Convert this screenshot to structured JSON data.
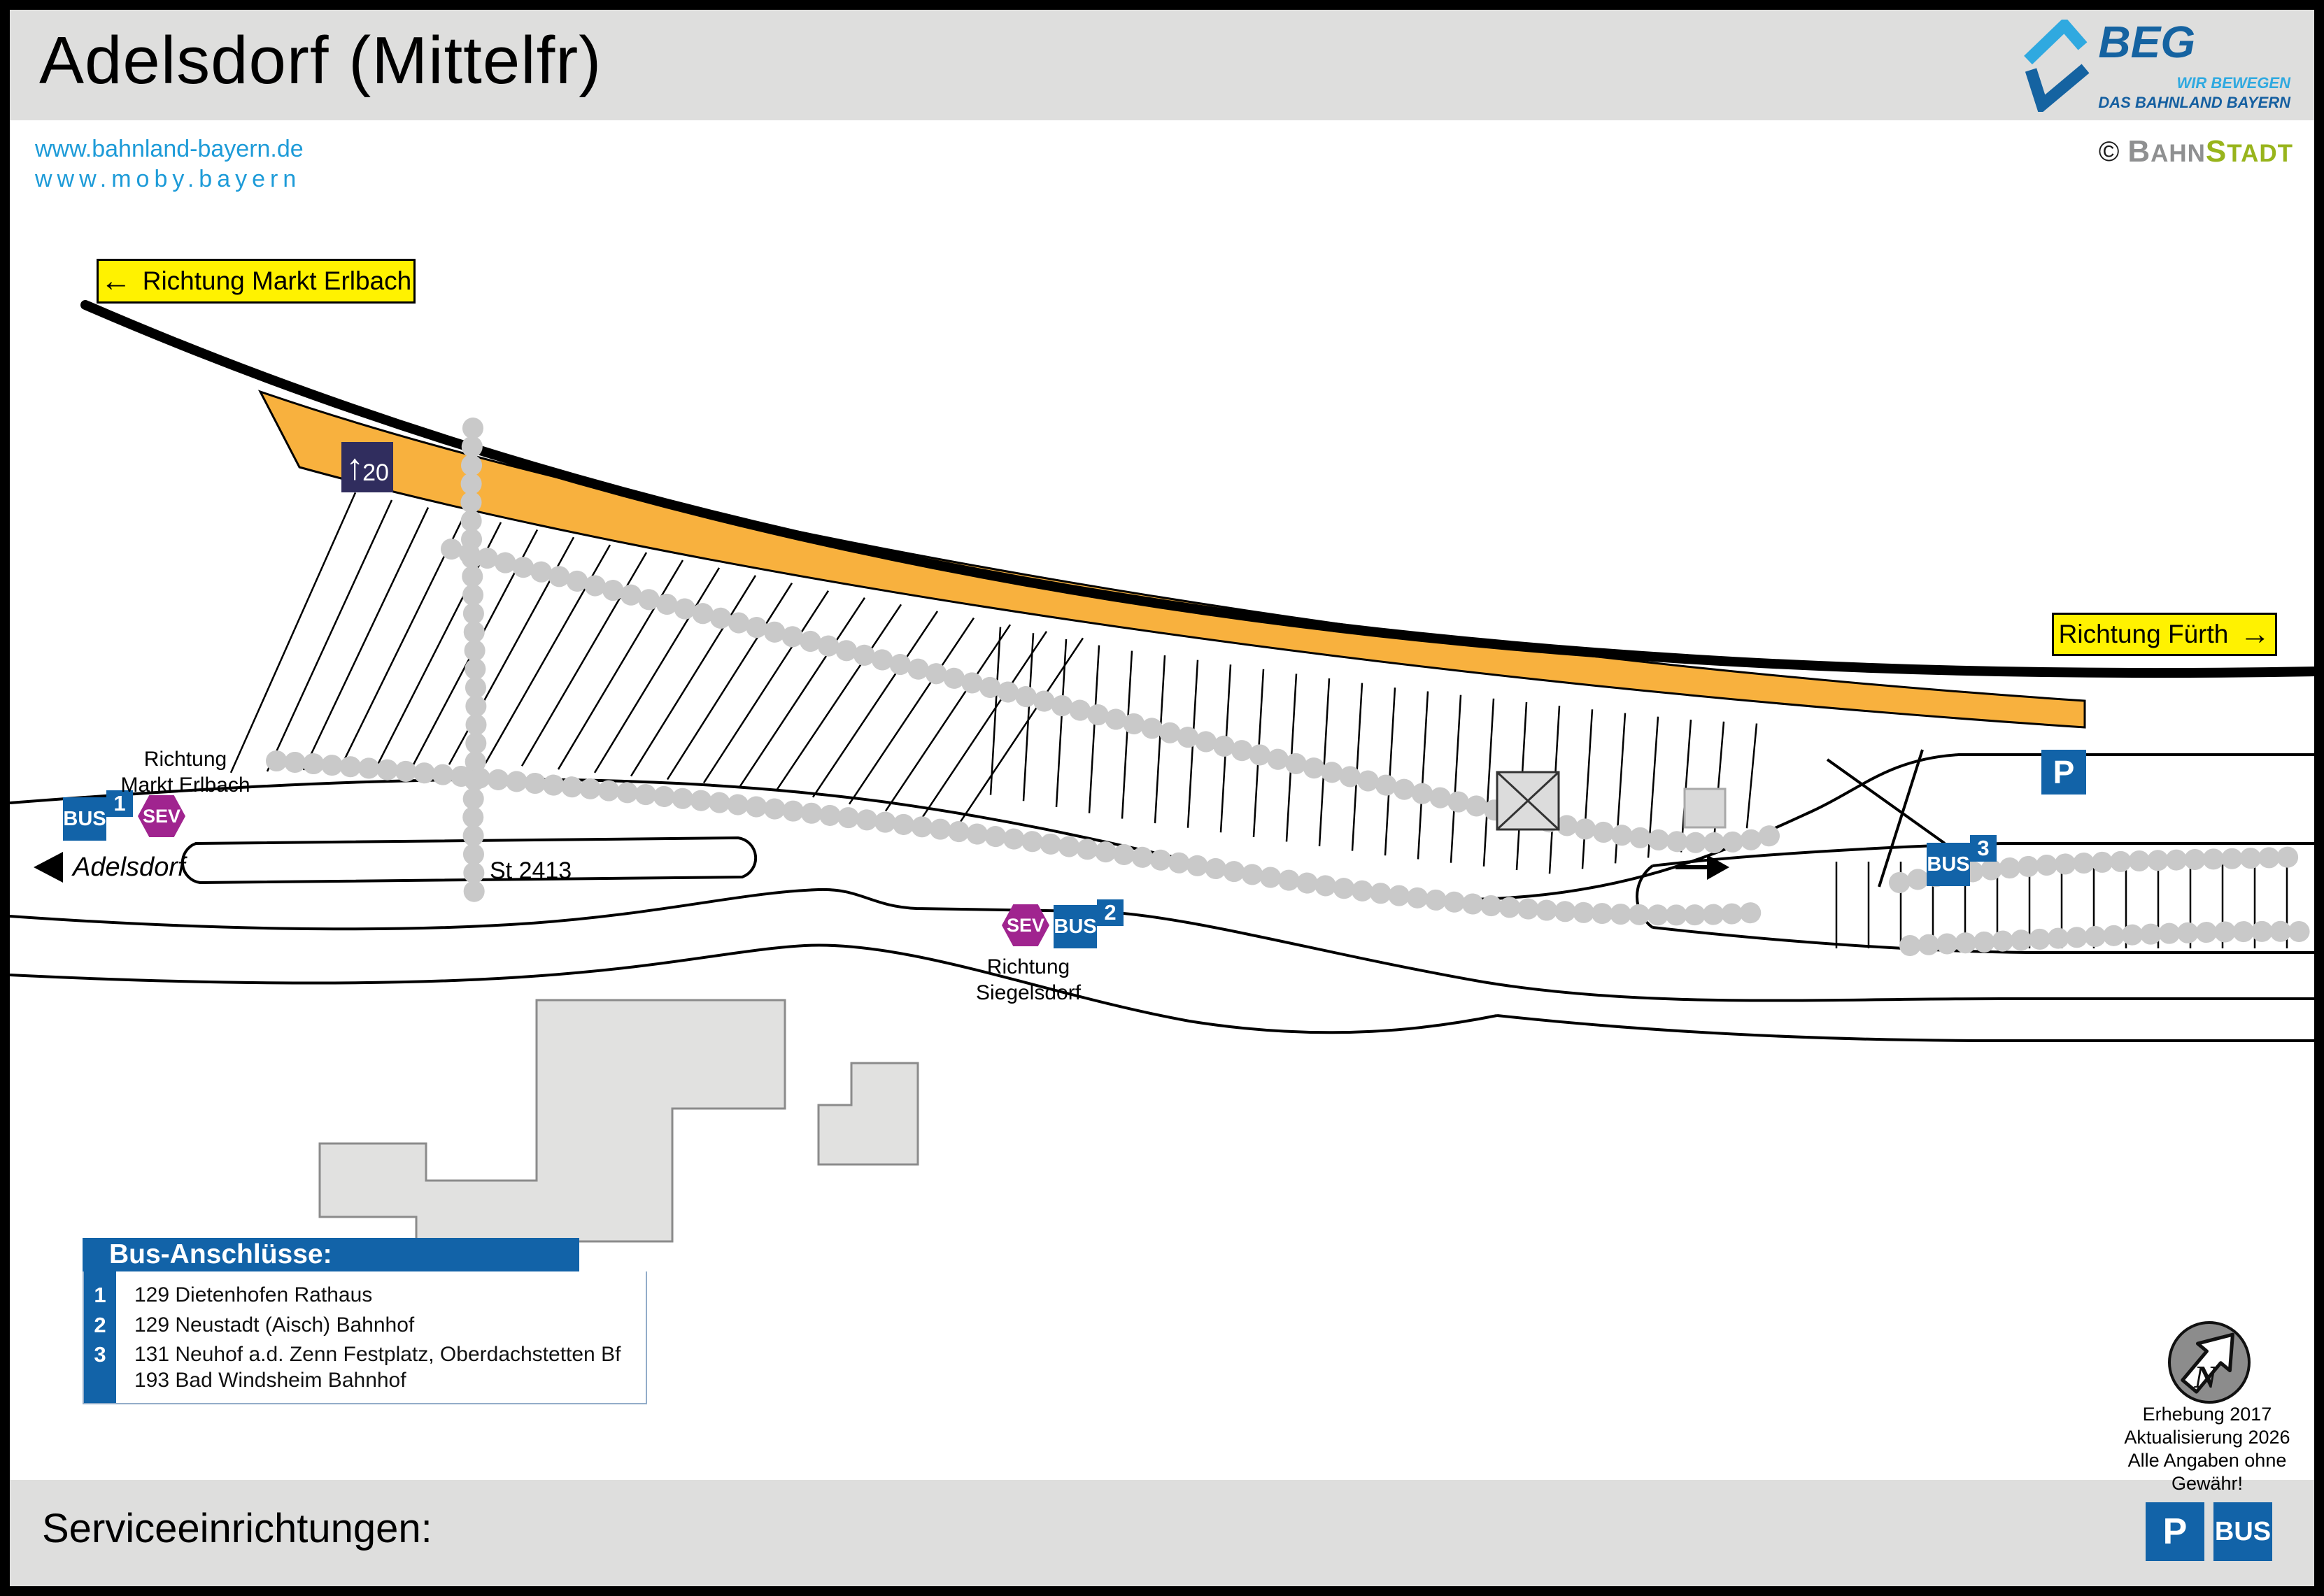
{
  "header": {
    "title": "Adelsdorf (Mittelfr)",
    "beg": {
      "name": "BEG",
      "line1": "WIR BEWEGEN",
      "line2": "DAS BAHNLAND BAYERN"
    },
    "credit": {
      "copyright": "©",
      "part1": "B",
      "part1b": "AHN",
      "part2": "S",
      "part2b": "TADT"
    }
  },
  "links": {
    "line1": "www.bahnland-bayern.de",
    "line2": "www.moby.bayern"
  },
  "map": {
    "sign_left": {
      "arrow": "←",
      "label": "Richtung Markt Erlbach"
    },
    "sign_right": {
      "label": "Richtung Fürth",
      "arrow": "→"
    },
    "platform_sign": {
      "arrow": "↑",
      "number": "20"
    },
    "road_label": "St 2413",
    "town_label": "Adelsdorf",
    "stop1": {
      "bus": "BUS",
      "badge": "1",
      "sev": "SEV",
      "label_line1": "Richtung",
      "label_line2": "Markt Erlbach"
    },
    "stop2": {
      "sev": "SEV",
      "bus": "BUS",
      "badge": "2",
      "label_line1": "Richtung",
      "label_line2": "Siegelsdorf"
    },
    "stop3": {
      "bus": "BUS",
      "badge": "3"
    },
    "parking_label": "P",
    "compass_n": "N",
    "notes": [
      "Erhebung 2017",
      "Aktualisierung 2026",
      "Alle Angaben ohne Gewähr!"
    ]
  },
  "legend": {
    "title": "Bus-Anschlüsse:",
    "rows": [
      {
        "num": "1",
        "lines": [
          "129 Dietenhofen Rathaus"
        ]
      },
      {
        "num": "2",
        "lines": [
          "129 Neustadt (Aisch) Bahnhof"
        ]
      },
      {
        "num": "3",
        "lines": [
          "131 Neuhof a.d. Zenn Festplatz, Oberdachstetten Bf",
          "193 Bad Windsheim Bahnhof"
        ]
      }
    ]
  },
  "footer": {
    "label": "Serviceeinrichtungen:",
    "icons": [
      {
        "label": "P"
      },
      {
        "label": "BUS"
      }
    ]
  },
  "colors": {
    "accent_blue": "#1263A8",
    "sev_purple": "#A0248F",
    "platform_orange": "#F8B13E",
    "sign_yellow": "#FFF200",
    "navy_sign": "#302D5E",
    "link_blue": "#1D9BD8",
    "beg_dark_blue": "#1563A1",
    "beg_light_blue": "#2FA9E0",
    "bahn_gray": "#8F9091",
    "stadt_green": "#98B41C",
    "header_gray": "#DEDEDD",
    "building_gray": "#E1E1E0",
    "hedge_gray": "#C9C9C9"
  }
}
